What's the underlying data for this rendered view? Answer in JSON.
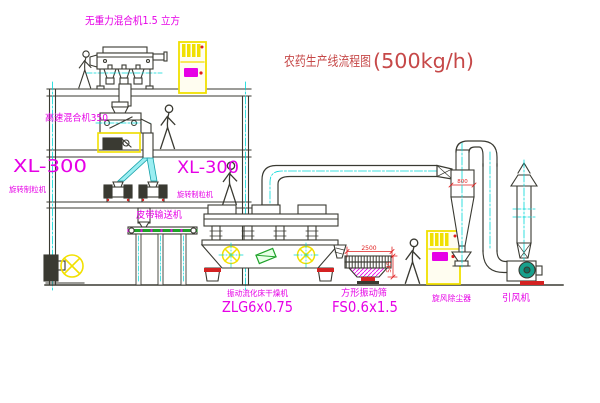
{
  "title": {
    "text": "农药生产线流程图",
    "capacity": "(500kg/h)"
  },
  "labels": {
    "gravity_mixer": "无重力混合机1.5 立方",
    "high_speed_mixer": "高速混合机350",
    "xl300_left": "XL-300",
    "xl300_left_name": "旋转制粒机",
    "xl300_right": "XL-300",
    "xl300_right_name": "旋转制粒机",
    "belt_conveyor": "皮带输送机",
    "dryer_name": "振动流化床干燥机",
    "dryer_model": "ZLG6x0.75",
    "screen_name": "方形振动筛",
    "screen_model": "FS0.6x1.5",
    "cyclone_name": "旋风除尘器",
    "fan_name": "引风机"
  },
  "dimensions": {
    "screen_length": "2500",
    "cyclone_width": "800",
    "screen_height": "545"
  },
  "colors": {
    "line": "#3a3a32",
    "centerline_cyan": "#00d8d8",
    "label_magenta": "#e600e6",
    "title_red": "#c64848",
    "dimension_red": "#e02020",
    "cabinet_yellow": "#f2e000",
    "chute_cyan": "#9beef2",
    "fan_teal": "#17a08c",
    "motor_green": "#1fa32a",
    "base_red": "#d42222"
  }
}
